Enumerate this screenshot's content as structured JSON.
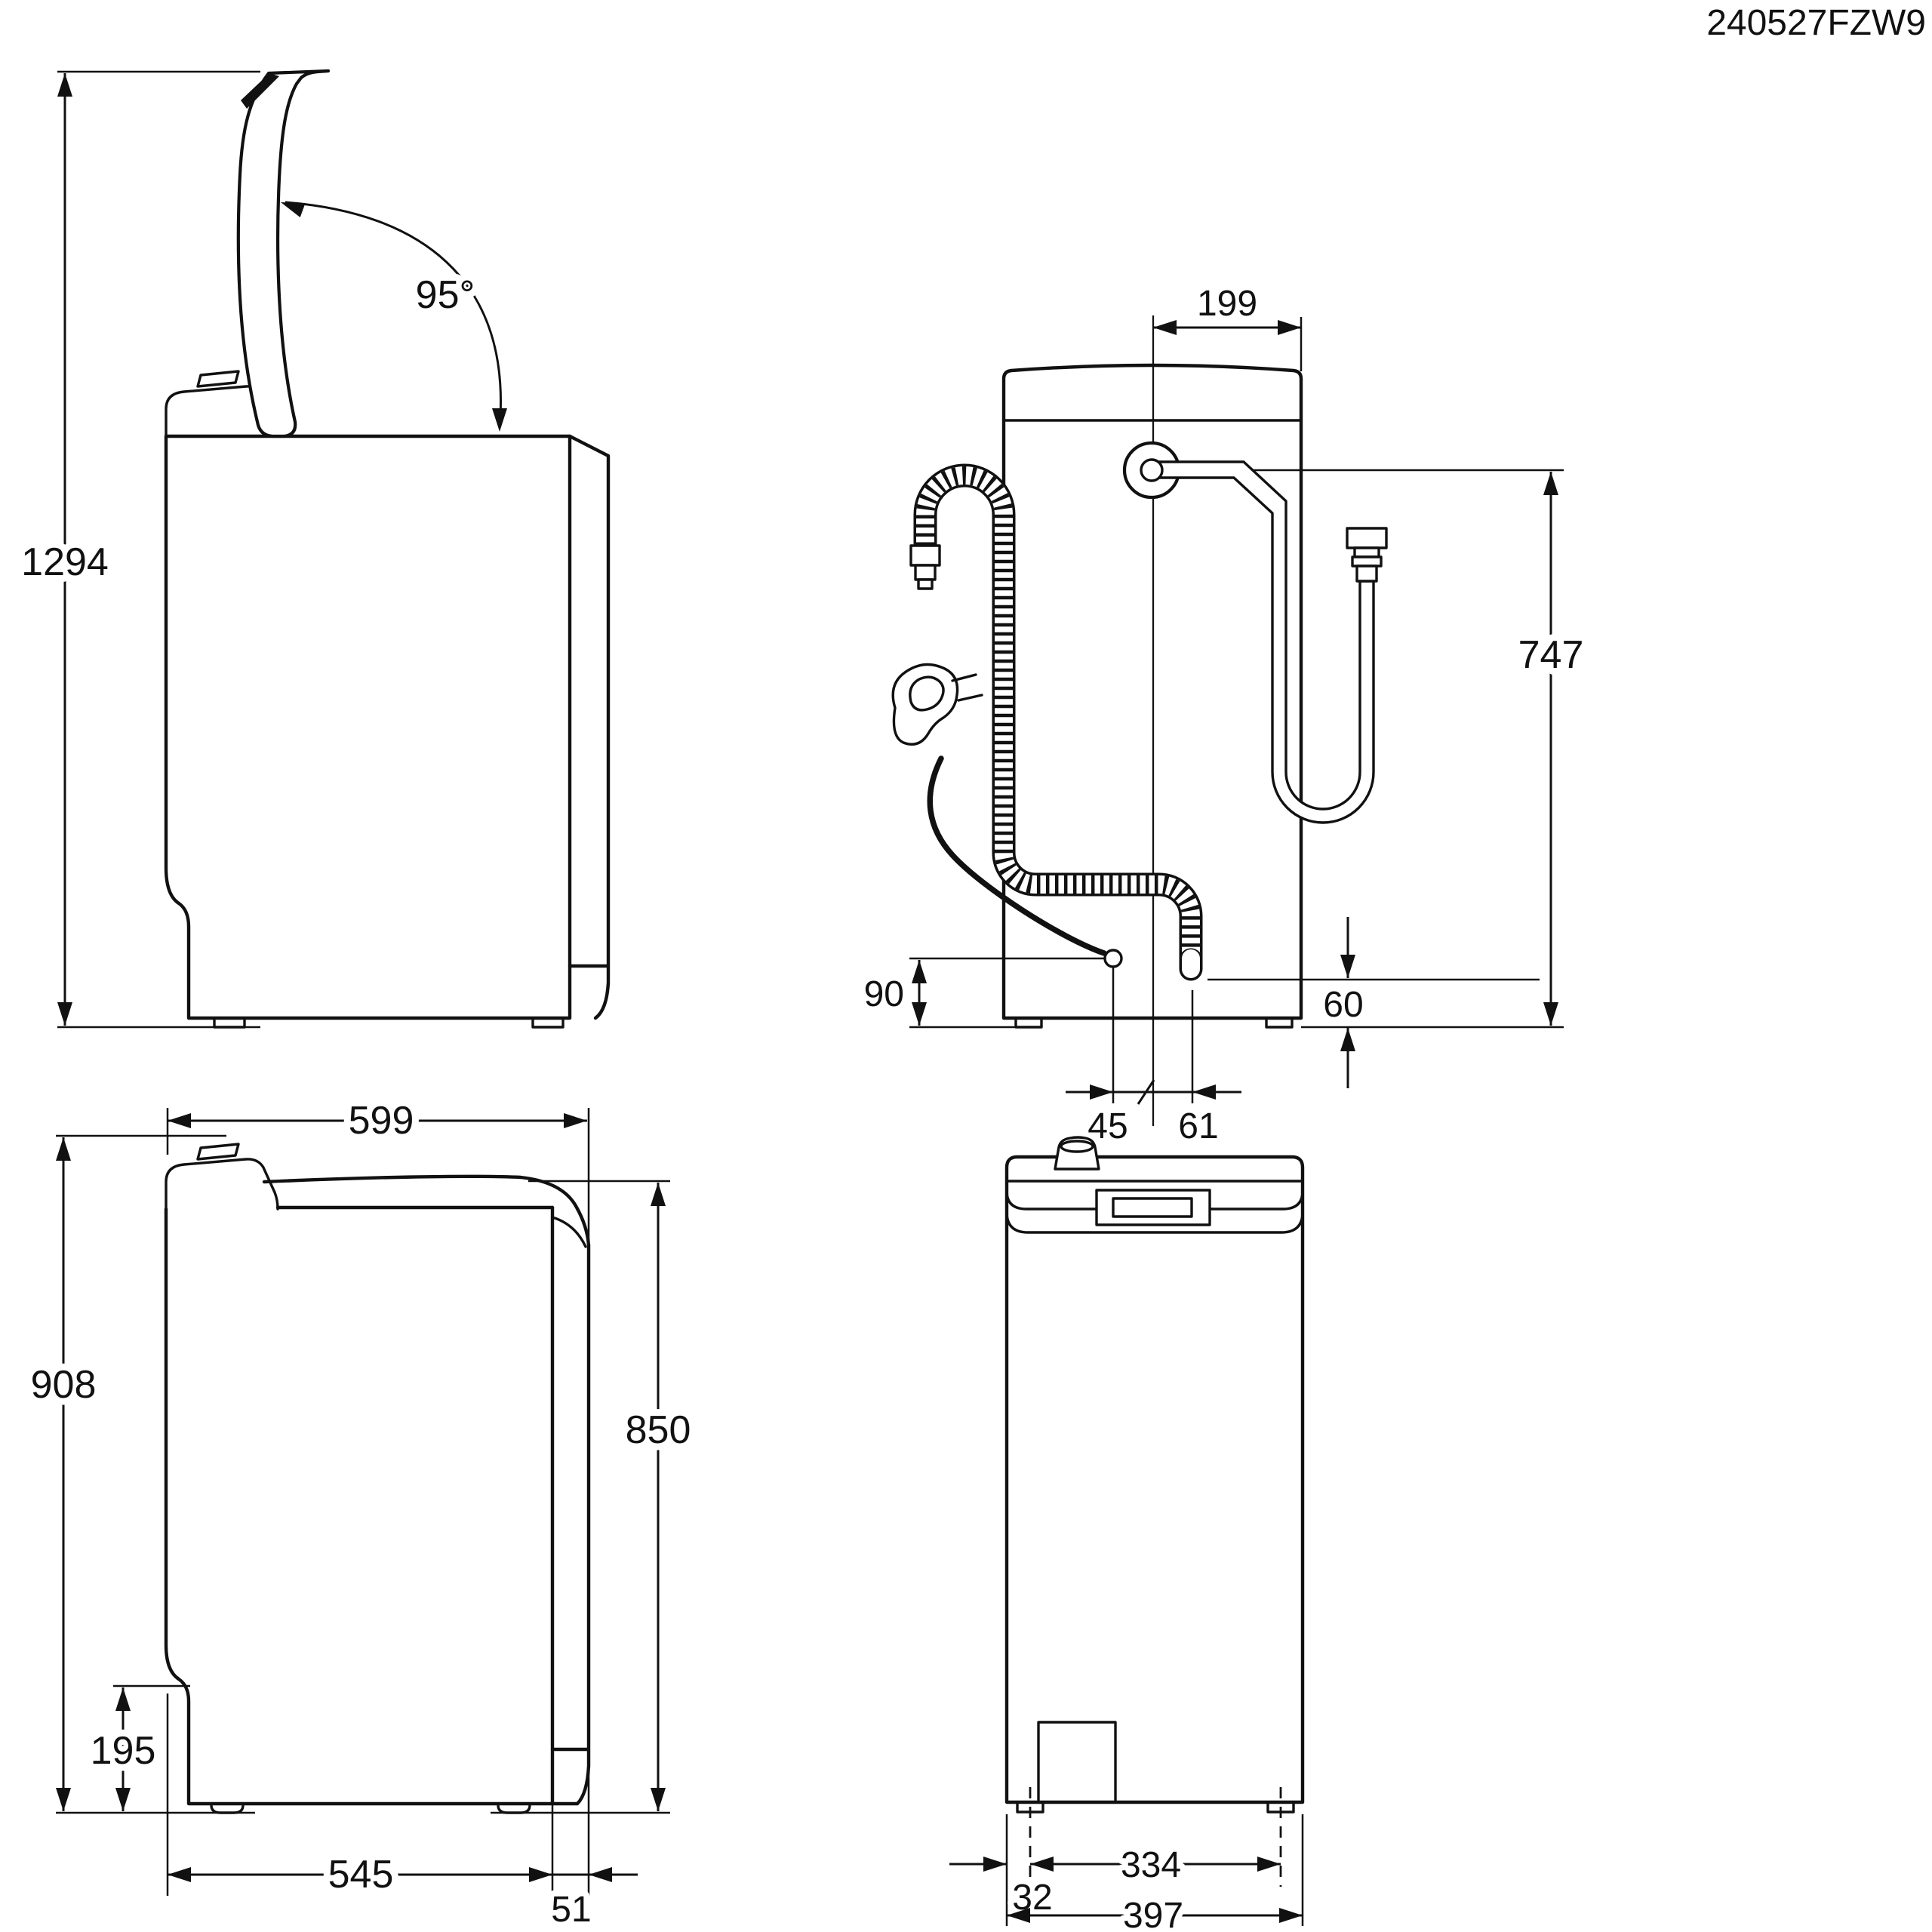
{
  "drawing": {
    "code": "240527FZW9",
    "views": {
      "side_lid_open": {
        "dims": {
          "overall_height_lid_open": "1294",
          "lid_opening_angle": "95°"
        }
      },
      "rear_connections": {
        "dims": {
          "inlet_to_right_edge": "199",
          "inlet_hose_height": "747",
          "cord_exit_height": "90",
          "drain_hose_clearance": "60",
          "cord_to_centre": "45",
          "centre_to_drain": "61"
        }
      },
      "side_lid_closed": {
        "dims": {
          "overall_width": "599",
          "overall_height": "908",
          "worktop_height": "850",
          "base_recess_height": "195",
          "base_depth": "545",
          "rear_panel_depth": "51"
        }
      },
      "rear_elevation": {
        "dims": {
          "feet_spacing": "334",
          "edge_to_foot": "32",
          "overall_depth": "397"
        }
      }
    }
  }
}
